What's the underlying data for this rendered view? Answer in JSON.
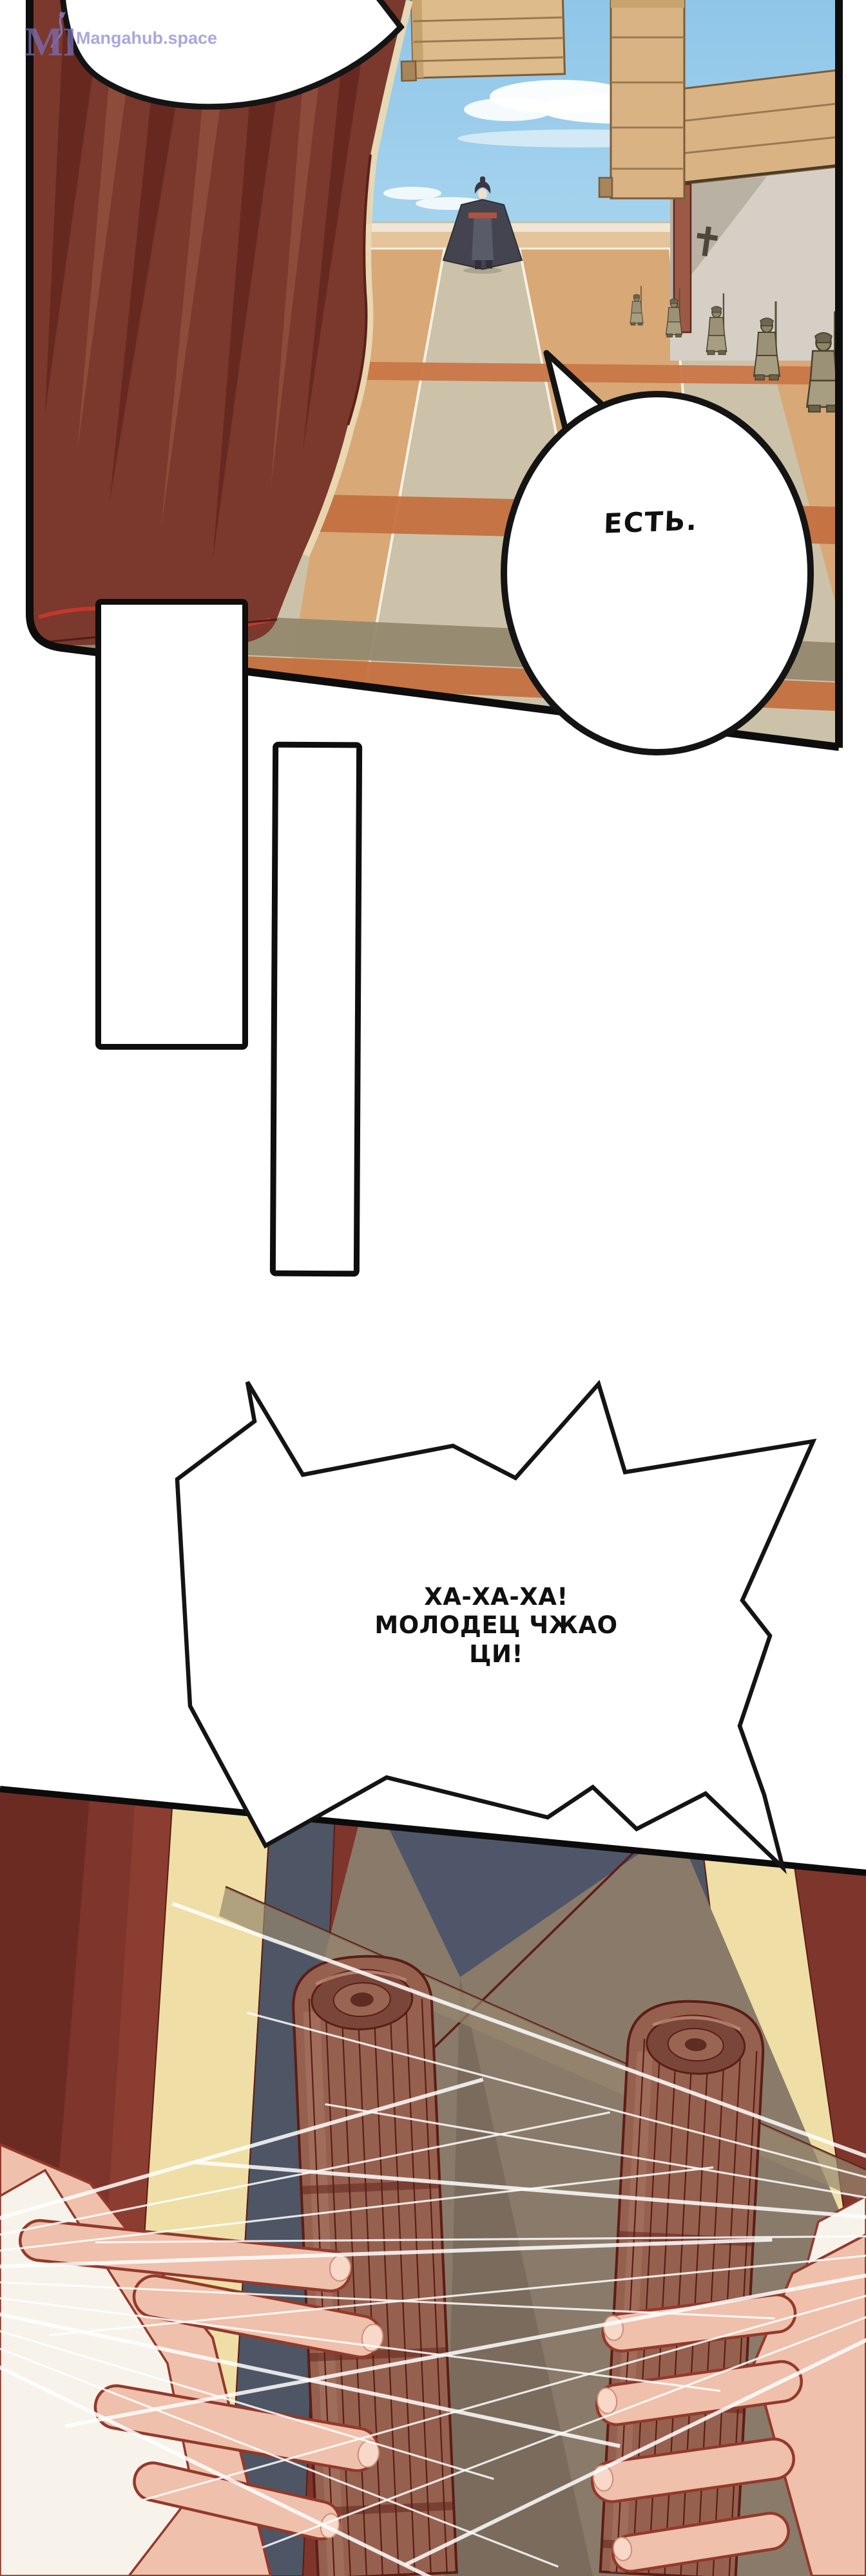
{
  "watermark": {
    "logo_initials": "MH",
    "site_name": "Mangahub.space",
    "color": "#968ED6"
  },
  "bubbles": {
    "yes_sir": {
      "shape": "oval",
      "text": "ЕСТЬ."
    },
    "laugh": {
      "shape": "burst",
      "lines": [
        "ХА-ХА-ХА!",
        "МОЛОДЕЦ ЧЖАО",
        "ЦИ!"
      ]
    }
  },
  "panels": {
    "top": {
      "alt": "palace courtyard, figure walking between guard rows, red curtain at left"
    },
    "middle": {
      "alt": "two empty white panel bars"
    },
    "bottom": {
      "alt": "two hands gripping a pair of rolled bamboo scrolls, speed lines"
    }
  },
  "palette": {
    "sky": "#8FC6E8",
    "curtain_red": "#7B382C",
    "floor_tan": "#D8A877",
    "path_gray": "#CBC2A9",
    "stripe_orange": "#C4703F",
    "guard_olive": "#9B9176",
    "wood_beam": "#DDBB8A",
    "deep_red_bg": "#7E352B",
    "cream_band": "#EFDFA6",
    "blue_gray": "#4E5564",
    "robe_brown": "#8A7A69",
    "scroll_brown": "#96604F",
    "scroll_outline": "#5B1D15",
    "skin": "#EFC0AB",
    "skin_outline": "#93392B",
    "ink": "#111111"
  }
}
